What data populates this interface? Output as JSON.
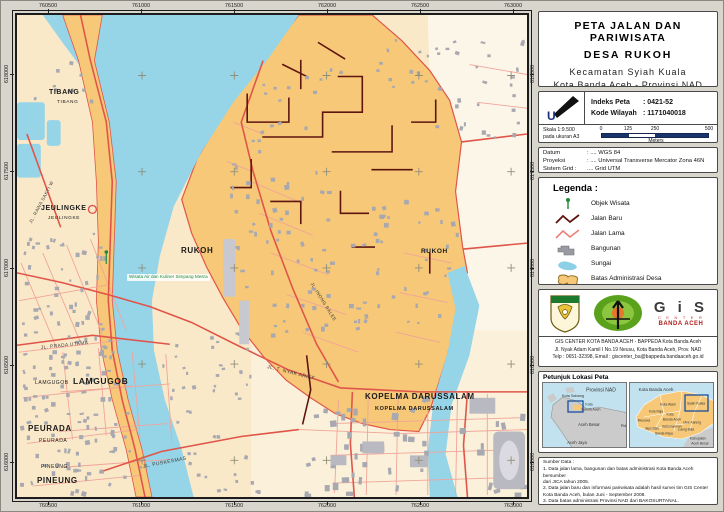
{
  "colors": {
    "village_fill": "#F6C877",
    "water": "#96D4E8",
    "road_old": "#E0554A",
    "road_minor": "#F1A49A",
    "road_new": "#5E1510",
    "building": "#A8A8B0",
    "accent_navy": "#17356B",
    "poi_green": "#1F8A3A"
  },
  "map": {
    "grid": {
      "top": [
        "760500",
        "761000",
        "761500",
        "762000",
        "762500",
        "763000"
      ],
      "bottom": [
        "760500",
        "761000",
        "761500",
        "762000",
        "762500",
        "763000"
      ],
      "left": [
        "618000",
        "617500",
        "617000",
        "616500",
        "616000"
      ],
      "right": [
        "618000",
        "617500",
        "617000",
        "616500",
        "616000"
      ]
    },
    "labels": [
      {
        "text": "TIBANG",
        "x": 34,
        "y": 76,
        "size": 7,
        "bold": 1,
        "rot": 0,
        "kind": "area"
      },
      {
        "text": "TIBANG",
        "x": 42,
        "y": 88,
        "size": 4.8,
        "bold": 0,
        "rot": 0,
        "kind": "area"
      },
      {
        "text": "JEULINGKE",
        "x": 26,
        "y": 192,
        "size": 7,
        "bold": 1,
        "rot": 0,
        "kind": "area"
      },
      {
        "text": "JEULINGKE",
        "x": 33,
        "y": 204,
        "size": 4.8,
        "bold": 0,
        "rot": 0,
        "kind": "area"
      },
      {
        "text": "RUKOH",
        "x": 166,
        "y": 234,
        "size": 8,
        "bold": 1,
        "rot": 0,
        "kind": "area"
      },
      {
        "text": "RUKOH",
        "x": 406,
        "y": 236,
        "size": 6.5,
        "bold": 1,
        "rot": 0,
        "kind": "area"
      },
      {
        "text": "LAMGUGOB",
        "x": 20,
        "y": 368,
        "size": 5,
        "bold": 0,
        "rot": 0,
        "kind": "area"
      },
      {
        "text": "LAMGUGOB",
        "x": 58,
        "y": 364,
        "size": 8.5,
        "bold": 1,
        "rot": 0,
        "kind": "area"
      },
      {
        "text": "PEURADA",
        "x": 13,
        "y": 412,
        "size": 8,
        "bold": 1,
        "rot": 0,
        "kind": "area"
      },
      {
        "text": "PEURADA",
        "x": 24,
        "y": 426,
        "size": 5,
        "bold": 0,
        "rot": 0,
        "kind": "area"
      },
      {
        "text": "PINEUNG",
        "x": 26,
        "y": 452,
        "size": 5,
        "bold": 0,
        "rot": 0,
        "kind": "area"
      },
      {
        "text": "PINEUNG",
        "x": 22,
        "y": 464,
        "size": 8,
        "bold": 1,
        "rot": 0,
        "kind": "area"
      },
      {
        "text": "KOPELMA DARUSSALAM",
        "x": 350,
        "y": 380,
        "size": 8,
        "bold": 1,
        "rot": 0,
        "kind": "area"
      },
      {
        "text": "KOPELMA DARUSSALAM",
        "x": 360,
        "y": 394,
        "size": 5.5,
        "bold": 1,
        "rot": 0,
        "kind": "area"
      },
      {
        "text": "JL. RAWA SAKTI W",
        "x": 16,
        "y": 208,
        "size": 4.6,
        "bold": 0,
        "rot": -62,
        "kind": "street"
      },
      {
        "text": "JL. PRADA UTAMA",
        "x": 26,
        "y": 334,
        "size": 4.8,
        "bold": 0,
        "rot": -6,
        "kind": "street"
      },
      {
        "text": "JL. T. NYAK ARIEF",
        "x": 252,
        "y": 352,
        "size": 5,
        "bold": 0,
        "rot": 14,
        "kind": "street"
      },
      {
        "text": "JL. PUSKESMAS",
        "x": 128,
        "y": 452,
        "size": 5,
        "bold": 0,
        "rot": -11,
        "kind": "street"
      },
      {
        "text": "JL. INONG BALEE",
        "x": 296,
        "y": 268,
        "size": 4.6,
        "bold": 0,
        "rot": 58,
        "kind": "street"
      },
      {
        "text": "Wisata Air dan Kuliner Simpang Mesra",
        "x": 112,
        "y": 261,
        "size": 4.6,
        "bold": 0,
        "rot": 0,
        "kind": "poi"
      }
    ]
  },
  "panel": {
    "title": {
      "line1": "PETA JALAN DAN PARIWISATA",
      "line2": "DESA RUKOH",
      "line3": "Kecamatan Syiah Kuala",
      "line4": "Kota Banda Aceh - Provinsi NAD"
    },
    "index": {
      "north_label": "U",
      "indeks_label": "Indeks Peta",
      "indeks_value": ": 0421-52",
      "kode_label": "Kode Wilayah",
      "kode_value": ": 1171040018"
    },
    "scale": {
      "skala": "Skala 1:9.500",
      "paper": "pada ukuran A3",
      "ticks": [
        "0",
        "125",
        "250",
        "500"
      ],
      "unit": "Meters"
    },
    "datum_rows": [
      {
        "label": "Datum",
        "value": ": .... WGS 84"
      },
      {
        "label": "Proyeksi",
        "value": ": .... Universal Transverse Mercator Zona 46N"
      },
      {
        "label": "Sistem Grid :",
        "value": " .... Grid UTM"
      }
    ],
    "legend": {
      "title": "Legenda :",
      "items": [
        {
          "icon": "objek-wisata",
          "label": "Objek Wisata"
        },
        {
          "icon": "jalan-baru",
          "label": "Jalan Baru"
        },
        {
          "icon": "jalan-lama",
          "label": "Jalan Lama"
        },
        {
          "icon": "bangunan",
          "label": "Bangunan"
        },
        {
          "icon": "sungai",
          "label": "Sungai"
        },
        {
          "icon": "batas-administrasi",
          "label": "Batas Administrasi Desa"
        }
      ]
    },
    "agency": {
      "wordmark_big": "G i S",
      "wordmark_center": "C E N T E R",
      "wordmark_city": "BANDA ACEH",
      "line1": "GIS CENTER KOTA BANDA ACEH - BAPPEDA Kota Banda Aceh",
      "line2": "Jl. Nyak Adam Kamil I No.19 Neusu, Kota Banda Aceh, Prov. NAD",
      "line3": "Telp : 0651-32398, Email : giscenter_ba@bappeda.bandaaceh.go.id"
    },
    "locator": {
      "title": "Petunjuk Lokasi Peta",
      "left_labels": [
        {
          "text": "Provinsi NAD",
          "x": 58,
          "y": 8,
          "size": 5
        },
        {
          "text": "Kota Sabang",
          "x": 30,
          "y": 14,
          "size": 3.8
        },
        {
          "text": "Kota",
          "x": 46,
          "y": 22,
          "size": 3.5
        },
        {
          "text": "Banda Aceh",
          "x": 48,
          "y": 27,
          "size": 3.5
        },
        {
          "text": "Aceh Besar",
          "x": 46,
          "y": 42,
          "size": 4.2
        },
        {
          "text": "Pidie",
          "x": 82,
          "y": 44,
          "size": 3.8
        },
        {
          "text": "Aceh Jaya",
          "x": 34,
          "y": 60,
          "size": 4.2
        }
      ],
      "right_labels": [
        {
          "text": "Kota Banda Aceh",
          "x": 26,
          "y": 7,
          "size": 4.5
        },
        {
          "text": "Kuta Alam",
          "x": 38,
          "y": 22,
          "size": 3.4
        },
        {
          "text": "Syiah Kuala",
          "x": 66,
          "y": 21,
          "size": 3.4
        },
        {
          "text": "Kuta Raja",
          "x": 26,
          "y": 29,
          "size": 3.2
        },
        {
          "text": "Kota",
          "x": 40,
          "y": 32,
          "size": 3.4
        },
        {
          "text": "Banda Aceh",
          "x": 42,
          "y": 37,
          "size": 3.4
        },
        {
          "text": "Meuraxa",
          "x": 14,
          "y": 38,
          "size": 3.2
        },
        {
          "text": "Jaya Baru",
          "x": 22,
          "y": 46,
          "size": 3.2
        },
        {
          "text": "Baiturrahman",
          "x": 42,
          "y": 44,
          "size": 3.2
        },
        {
          "text": "Lueng Bata",
          "x": 56,
          "y": 47,
          "size": 3.2
        },
        {
          "text": "Ulee Kareng",
          "x": 62,
          "y": 40,
          "size": 3.2
        },
        {
          "text": "Banda Raya",
          "x": 34,
          "y": 51,
          "size": 3.2
        },
        {
          "text": "Kabupaten",
          "x": 68,
          "y": 56,
          "size": 3.4
        },
        {
          "text": "Aceh Besar",
          "x": 70,
          "y": 61,
          "size": 3.4
        }
      ]
    },
    "sources": {
      "title": "Sumber Data :",
      "lines": [
        "1. Data jalan lama, bangunan dan batas administrasi Kota Banda Aceh bersumber",
        "    dari JICA tahun 2005.",
        "2. Data jalan baru dan informasi pariwisata adalah hasil survei tim GIS Center",
        "    Kota Banda Aceh, bulan Juni - September 2008.",
        "3. Data batas administrasi Provinsi NAD dari BAKOSURTANAL.",
        "Peta dibuat oleh Tim GIS Center Kota Banda Aceh, bulan September 2008."
      ]
    }
  }
}
